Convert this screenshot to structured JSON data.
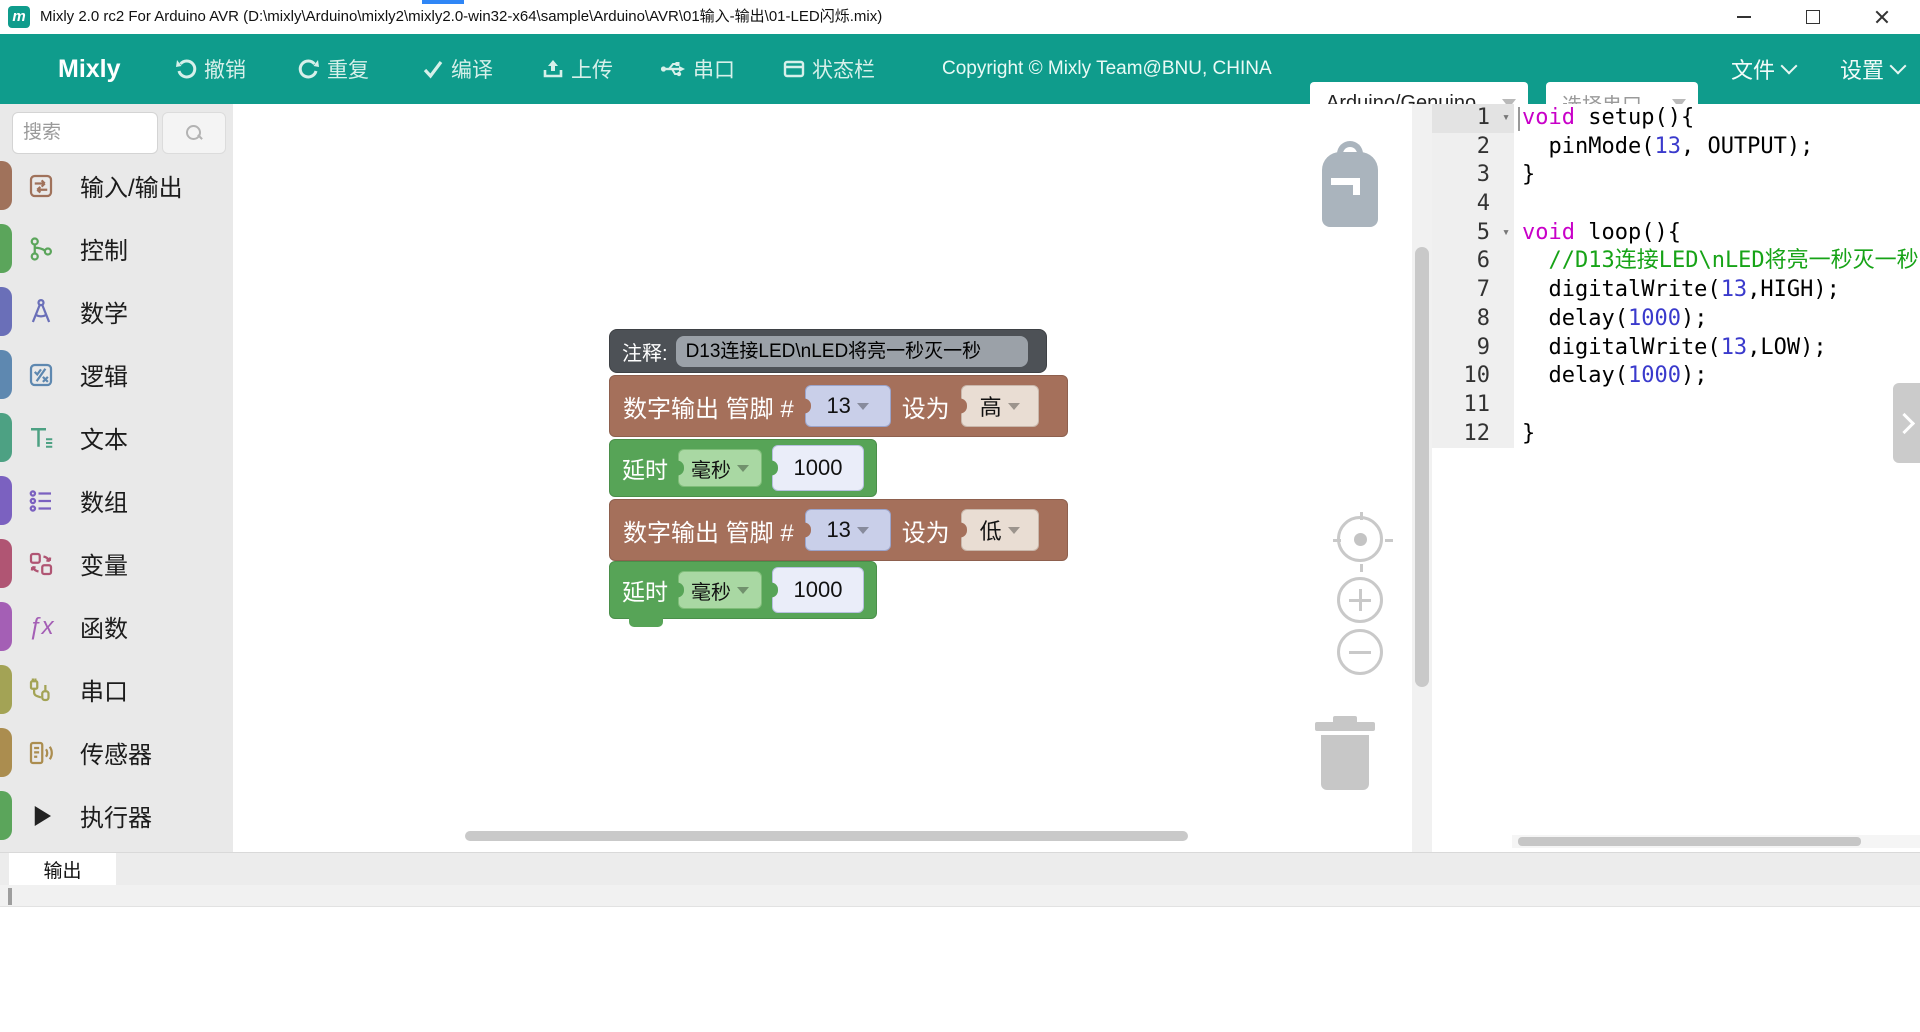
{
  "window": {
    "title": "Mixly 2.0 rc2 For Arduino AVR (D:\\mixly\\Arduino\\mixly2\\mixly2.0-win32-x64\\sample\\Arduino\\AVR\\01输入-输出\\01-LED闪烁.mix)",
    "brand_letter": "m"
  },
  "toolbar": {
    "accent_color": "#0f9c8c",
    "brand": "Mixly",
    "buttons": [
      {
        "label": "撤销",
        "icon": "undo-icon"
      },
      {
        "label": "重复",
        "icon": "redo-icon"
      },
      {
        "label": "编译",
        "icon": "compile-icon"
      },
      {
        "label": "上传",
        "icon": "upload-icon"
      },
      {
        "label": "串口",
        "icon": "serial-icon"
      },
      {
        "label": "状态栏",
        "icon": "statusbar-icon"
      }
    ],
    "copyright": "Copyright © Mixly Team@BNU, CHINA",
    "board_select": "Arduino/Genuino",
    "port_select": "选择串口",
    "menus": [
      {
        "label": "文件"
      },
      {
        "label": "设置"
      }
    ]
  },
  "sidebar": {
    "search_placeholder": "搜索",
    "categories": [
      {
        "label": "输入/输出",
        "color": "#A0725B"
      },
      {
        "label": "控制",
        "color": "#5BA55B"
      },
      {
        "label": "数学",
        "color": "#6A6FB8"
      },
      {
        "label": "逻辑",
        "color": "#5E88B0"
      },
      {
        "label": "文本",
        "color": "#4DA183"
      },
      {
        "label": "数组",
        "color": "#7B61C0"
      },
      {
        "label": "变量",
        "color": "#B05573"
      },
      {
        "label": "函数",
        "color": "#A45FB5"
      },
      {
        "label": "串口",
        "color": "#A3A355"
      },
      {
        "label": "传感器",
        "color": "#AB8D4F"
      },
      {
        "label": "执行器",
        "color": "#5BA55B",
        "icon_color": "#222222"
      }
    ]
  },
  "workspace": {
    "comment_block": {
      "label": "注释:",
      "value": "D13连接LED\\nLED将亮一秒灭一秒",
      "color": "#4d5156"
    },
    "blocks": [
      {
        "type": "digital_write",
        "label1": "数字输出 管脚 #",
        "pin": "13",
        "label2": "设为",
        "value": "高",
        "color": "#A5705B"
      },
      {
        "type": "delay",
        "label": "延时",
        "unit": "毫秒",
        "value": "1000",
        "color": "#57A457"
      },
      {
        "type": "digital_write",
        "label1": "数字输出 管脚 #",
        "pin": "13",
        "label2": "设为",
        "value": "低",
        "color": "#A5705B"
      },
      {
        "type": "delay",
        "label": "延时",
        "unit": "毫秒",
        "value": "1000",
        "color": "#57A457"
      }
    ]
  },
  "code_panel": {
    "colors": {
      "kw": "#C800C8",
      "num": "#3A3ACC",
      "cmt": "#17A317",
      "pl": "#000000"
    },
    "lines": [
      {
        "n": 1,
        "fold": true,
        "segs": [
          [
            "void",
            "kw"
          ],
          [
            " setup(){",
            "pl"
          ]
        ]
      },
      {
        "n": 2,
        "segs": [
          [
            "  pinMode(",
            "pl"
          ],
          [
            "13",
            "num"
          ],
          [
            ", OUTPUT);",
            "pl"
          ]
        ]
      },
      {
        "n": 3,
        "segs": [
          [
            "}",
            "pl"
          ]
        ]
      },
      {
        "n": 4,
        "segs": []
      },
      {
        "n": 5,
        "fold": true,
        "segs": [
          [
            "void",
            "kw"
          ],
          [
            " loop(){",
            "pl"
          ]
        ]
      },
      {
        "n": 6,
        "segs": [
          [
            "  //D13连接LED\\nLED将亮一秒灭一秒",
            "cmt"
          ]
        ]
      },
      {
        "n": 7,
        "segs": [
          [
            "  digitalWrite(",
            "pl"
          ],
          [
            "13",
            "num"
          ],
          [
            ",HIGH);",
            "pl"
          ]
        ]
      },
      {
        "n": 8,
        "segs": [
          [
            "  delay(",
            "pl"
          ],
          [
            "1000",
            "num"
          ],
          [
            ");",
            "pl"
          ]
        ]
      },
      {
        "n": 9,
        "segs": [
          [
            "  digitalWrite(",
            "pl"
          ],
          [
            "13",
            "num"
          ],
          [
            ",LOW);",
            "pl"
          ]
        ]
      },
      {
        "n": 10,
        "segs": [
          [
            "  delay(",
            "pl"
          ],
          [
            "1000",
            "num"
          ],
          [
            ");",
            "pl"
          ]
        ]
      },
      {
        "n": 11,
        "segs": []
      },
      {
        "n": 12,
        "segs": [
          [
            "}",
            "pl"
          ]
        ]
      }
    ]
  },
  "bottom_panel": {
    "tab": "输出"
  }
}
